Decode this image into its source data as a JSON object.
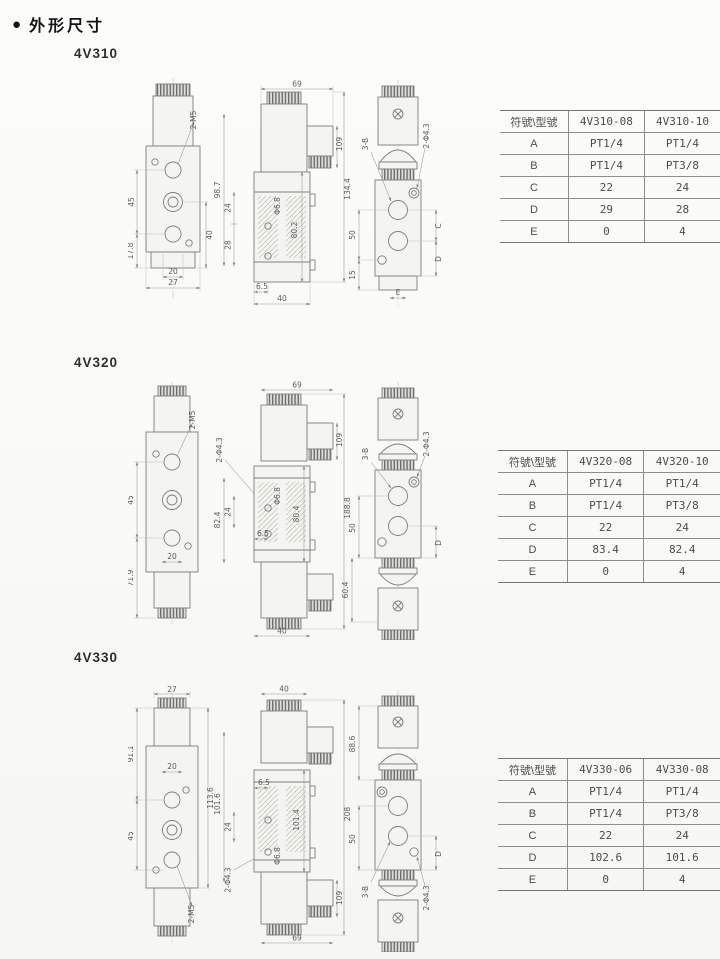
{
  "page": {
    "bullet": "●",
    "title": "外形尺寸"
  },
  "sections": [
    {
      "model": "4V310",
      "dims": {
        "v1_left_a": "45",
        "v1_left_b": "17.8",
        "v1_bot_a": "20",
        "v1_bot_b": "27",
        "v1_right": "40",
        "v1_label": "2-M5",
        "chain_a": "98.7",
        "chain_b": "24",
        "chain_c": "28",
        "v2_top": "69",
        "v2_hole": "Φ6.8",
        "v2_body": "80.2",
        "v2_total": "134.4",
        "v2_bot_a": "6.5",
        "v2_bot_b": "40",
        "v2_conn": "109",
        "v3_left_a": "50",
        "v3_left_b": "15",
        "v3_port": "3-B",
        "v3_holes": "2-Φ4.3",
        "v3_right_a": "C",
        "v3_right_b": "D",
        "v3_bot": "E"
      },
      "table": {
        "header": [
          "符號\\型號",
          "4V310-08",
          "4V310-10"
        ],
        "rows": [
          [
            "A",
            "PT1/4",
            "PT1/4"
          ],
          [
            "B",
            "PT1/4",
            "PT3/8"
          ],
          [
            "C",
            "22",
            "24"
          ],
          [
            "D",
            "29",
            "28"
          ],
          [
            "E",
            "0",
            "4"
          ]
        ]
      }
    },
    {
      "model": "4V320",
      "dims": {
        "v1_left_a": "45",
        "v1_left_b": "71.9",
        "v1_bot_a": "20",
        "v1_label": "2-M5",
        "chain_a": "2-Φ4.3",
        "chain_b": "24",
        "chain_c": "82.4",
        "v2_top": "69",
        "v2_hole": "Φ6.8",
        "v2_body": "80.4",
        "v2_total": "188.8",
        "v2_bot_a": "6.5",
        "v2_bot_b": "40",
        "v2_conn": "109",
        "v3_left_a": "50",
        "v3_left_b": "60.4",
        "v3_port": "3-B",
        "v3_holes": "2-Φ4.3",
        "v3_right_a": "D"
      },
      "table": {
        "header": [
          "符號\\型號",
          "4V320-08",
          "4V320-10"
        ],
        "rows": [
          [
            "A",
            "PT1/4",
            "PT1/4"
          ],
          [
            "B",
            "PT1/4",
            "PT3/8"
          ],
          [
            "C",
            "22",
            "24"
          ],
          [
            "D",
            "83.4",
            "82.4"
          ],
          [
            "E",
            "0",
            "4"
          ]
        ]
      }
    },
    {
      "model": "4V330",
      "dims": {
        "v1_top": "27",
        "v1_left_a": "91.1",
        "v1_left_b": "45",
        "v1_bot_a": "20",
        "v1_right": "113.6",
        "v1_label": "2-M5",
        "chain_a": "101.6",
        "chain_b": "24",
        "chain_c": "2-Φ4.3",
        "v2_top": "40",
        "v2_in": "6.5",
        "v2_body": "101.4",
        "v2_hole": "Φ6.8",
        "v2_bot": "69",
        "v2_total": "208",
        "v2_conn": "109",
        "v3_left_a": "88.6",
        "v3_left_b": "50",
        "v3_port": "3-B",
        "v3_holes": "2-Φ4.3",
        "v3_right_a": "D"
      },
      "table": {
        "header": [
          "符號\\型號",
          "4V330-06",
          "4V330-08"
        ],
        "rows": [
          [
            "A",
            "PT1/4",
            "PT1/4"
          ],
          [
            "B",
            "PT1/4",
            "PT3/8"
          ],
          [
            "C",
            "22",
            "24"
          ],
          [
            "D",
            "102.6",
            "101.6"
          ],
          [
            "E",
            "0",
            "4"
          ]
        ]
      }
    }
  ]
}
